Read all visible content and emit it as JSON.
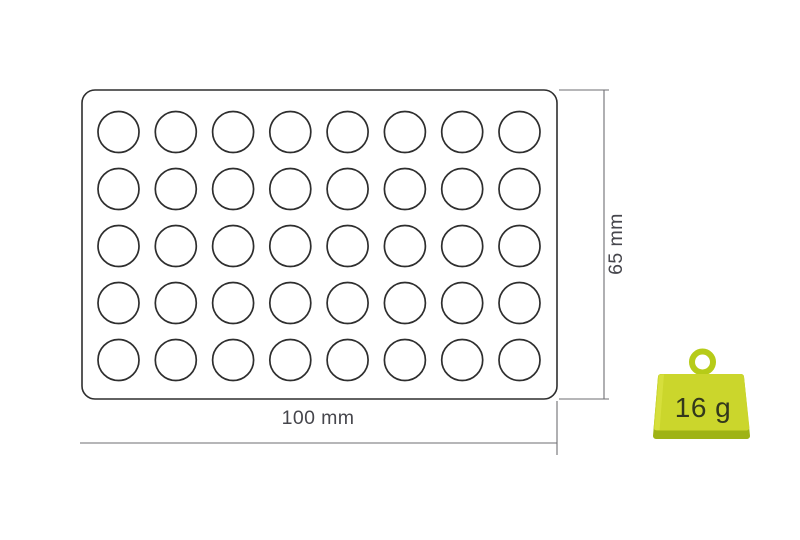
{
  "diagram": {
    "name": "Tray dimension diagram",
    "tray": {
      "rows": 5,
      "cols": 8,
      "cavity_count": 40
    },
    "dimensions": {
      "width_label": "100 mm",
      "height_label": "65 mm"
    },
    "weight_badge": {
      "label": "16 g"
    },
    "colors": {
      "background": "#ffffff",
      "outline": "#2e2e2e",
      "dimension_line": "#6e6e72",
      "label_text": "#46464c",
      "weight_body": "#cbd62c",
      "weight_body_light": "#e0e74a",
      "weight_shade": "#9fb315",
      "weight_ring": "#b6cb18",
      "weight_text": "#33381c"
    }
  }
}
